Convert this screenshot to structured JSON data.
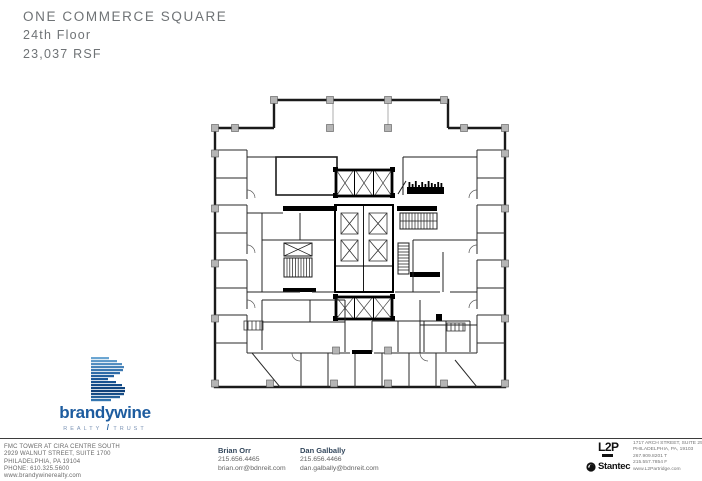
{
  "header": {
    "building": "ONE COMMERCE SQUARE",
    "floor": "24th Floor",
    "rsf": "23,037 RSF"
  },
  "floor_plan": {
    "label": "24th floor plan drawing",
    "colors": {
      "wall": "#1a1a1a",
      "core": "#000000",
      "column": "#b5b5b5"
    }
  },
  "brandywine": {
    "wordmark": "brandywine",
    "tagline_left": "REALTY",
    "tagline_slash": "/",
    "tagline_right": "TRUST",
    "brand_blue": "#1d5c9f",
    "address_lines": {
      "0": "FMC TOWER AT CIRA CENTRE SOUTH",
      "1": "2929 WALNUT STREET, SUITE 1700",
      "2": "PHILADELPHIA, PA 19104",
      "3": "PHONE: 610.325.5600",
      "4": "www.brandywinerealty.com"
    }
  },
  "contacts": {
    "0": {
      "name": "Brian Orr",
      "phone": "215.656.4465",
      "email": "brian.orr@bdnreit.com"
    },
    "1": {
      "name": "Dan Galbally",
      "phone": "215.656.4466",
      "email": "dan.galbally@bdnreit.com"
    }
  },
  "architect": {
    "l2p_mark": "L2P",
    "stantec_mark": "Stantec",
    "address_lines": {
      "0": "1717 ARCH STREET, SUITE 250",
      "1": "PHILADELPHIA, PA, 19103",
      "2": "267.909.8201 T",
      "3": "215.557.7854 F",
      "4": "www.L2Partridge.com"
    }
  }
}
